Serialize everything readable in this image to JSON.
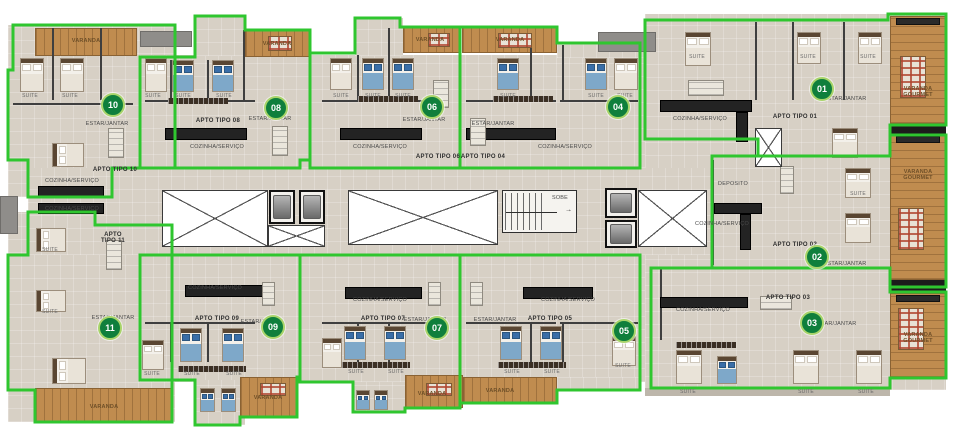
{
  "colors": {
    "outline_green": "#2fc62f",
    "badge_fill": "#0f7f3c",
    "badge_ring": "#a8d46a",
    "floor_beige": "#d7d0c5",
    "wood_tan": "#c08c4f",
    "counter_black": "#232323",
    "background": "#ffffff"
  },
  "apartments": [
    {
      "number": "01",
      "label": "APTO TIPO 01",
      "badge_x": 822,
      "badge_y": 89,
      "label_x": 795,
      "label_y": 117
    },
    {
      "number": "02",
      "label": "APTO TIPO 02",
      "badge_x": 817,
      "badge_y": 257,
      "label_x": 795,
      "label_y": 245
    },
    {
      "number": "03",
      "label": "APTO TIPO 03",
      "badge_x": 812,
      "badge_y": 323,
      "label_x": 788,
      "label_y": 298
    },
    {
      "number": "04",
      "label": "APTO TIPO 04",
      "badge_x": 618,
      "badge_y": 107,
      "label_x": 483,
      "label_y": 157
    },
    {
      "number": "05",
      "label": "APTO TIPO 05",
      "badge_x": 624,
      "badge_y": 331,
      "label_x": 550,
      "label_y": 319
    },
    {
      "number": "06",
      "label": "APTO TIPO 06",
      "badge_x": 432,
      "badge_y": 107,
      "label_x": 438,
      "label_y": 157
    },
    {
      "number": "07",
      "label": "APTO TIPO 07",
      "badge_x": 437,
      "badge_y": 328,
      "label_x": 383,
      "label_y": 319
    },
    {
      "number": "08",
      "label": "APTO TIPO 08",
      "badge_x": 276,
      "badge_y": 108,
      "label_x": 218,
      "label_y": 121
    },
    {
      "number": "09",
      "label": "APTO TIPO 09",
      "badge_x": 273,
      "badge_y": 327,
      "label_x": 217,
      "label_y": 319
    },
    {
      "number": "10",
      "label": "APTO TIPO 10",
      "badge_x": 113,
      "badge_y": 105,
      "label_x": 115,
      "label_y": 170
    },
    {
      "number": "11",
      "label": "APTO TIPO 11",
      "badge_x": 110,
      "badge_y": 328,
      "label_x": 113,
      "label_y": 238,
      "wrap": true
    }
  ],
  "labels": [
    {
      "text": "ESTAR/JANTAR",
      "x": 107,
      "y": 124,
      "cls": "rm"
    },
    {
      "text": "ESTAR/JANTAR",
      "x": 270,
      "y": 119,
      "cls": "rm"
    },
    {
      "text": "ESTAR/JANTAR",
      "x": 424,
      "y": 120,
      "cls": "rm"
    },
    {
      "text": "ESTAR/JANTAR",
      "x": 493,
      "y": 124,
      "cls": "rm"
    },
    {
      "text": "ESTAR/JANTAR",
      "x": 845,
      "y": 99,
      "cls": "rm"
    },
    {
      "text": "ESTAR/JANTAR",
      "x": 845,
      "y": 264,
      "cls": "rm"
    },
    {
      "text": "ESTAR/JANTAR",
      "x": 835,
      "y": 324,
      "cls": "rm"
    },
    {
      "text": "ESTAR/JANTAR",
      "x": 495,
      "y": 320,
      "cls": "rm"
    },
    {
      "text": "ESTAR/JANTAR",
      "x": 425,
      "y": 320,
      "cls": "rm"
    },
    {
      "text": "ESTAR/JANTAR",
      "x": 262,
      "y": 322,
      "cls": "rm"
    },
    {
      "text": "ESTAR/JANTAR",
      "x": 113,
      "y": 318,
      "cls": "rm"
    },
    {
      "text": "COZINHA/SERVIÇO",
      "x": 72,
      "y": 181,
      "cls": "rm"
    },
    {
      "text": "COZINHA/SERVIÇO",
      "x": 72,
      "y": 209,
      "cls": "rm"
    },
    {
      "text": "COZINHA/SERVIÇO",
      "x": 217,
      "y": 147,
      "cls": "rm"
    },
    {
      "text": "COZINHA/SERVIÇO",
      "x": 380,
      "y": 147,
      "cls": "rm"
    },
    {
      "text": "COZINHA/SERVIÇO",
      "x": 565,
      "y": 147,
      "cls": "rm"
    },
    {
      "text": "COZINHA/SERVIÇO",
      "x": 700,
      "y": 119,
      "cls": "rm"
    },
    {
      "text": "COZINHA/SERVIÇO",
      "x": 215,
      "y": 288,
      "cls": "rm"
    },
    {
      "text": "COZINHA/SERVIÇO",
      "x": 380,
      "y": 300,
      "cls": "rm"
    },
    {
      "text": "COZINHA/SERVIÇO",
      "x": 568,
      "y": 300,
      "cls": "rm"
    },
    {
      "text": "COZINHA/SERVIÇO",
      "x": 722,
      "y": 224,
      "cls": "rm"
    },
    {
      "text": "COZINHA/SERVIÇO",
      "x": 703,
      "y": 310,
      "cls": "rm"
    },
    {
      "text": "VARANDA",
      "x": 86,
      "y": 41,
      "cls": "wd"
    },
    {
      "text": "VARANDA",
      "x": 277,
      "y": 44,
      "cls": "wd"
    },
    {
      "text": "VARANDA",
      "x": 430,
      "y": 40,
      "cls": "wd"
    },
    {
      "text": "VARANDA",
      "x": 510,
      "y": 40,
      "cls": "wd"
    },
    {
      "text": "VARANDA",
      "x": 104,
      "y": 407,
      "cls": "wd"
    },
    {
      "text": "VARANDA",
      "x": 268,
      "y": 398,
      "cls": "wd"
    },
    {
      "text": "VARANDA",
      "x": 432,
      "y": 394,
      "cls": "wd"
    },
    {
      "text": "VARANDA",
      "x": 500,
      "y": 391,
      "cls": "wd"
    },
    {
      "text": "VARANDA GOURMET",
      "x": 918,
      "y": 92,
      "cls": "vg"
    },
    {
      "text": "VARANDA GOURMET",
      "x": 918,
      "y": 175,
      "cls": "vg"
    },
    {
      "text": "VARANDA GOURMET",
      "x": 918,
      "y": 338,
      "cls": "vg"
    },
    {
      "text": "DEPOSITO",
      "x": 733,
      "y": 184,
      "cls": "rm"
    },
    {
      "text": "SOBE",
      "x": 560,
      "y": 198,
      "cls": "rm"
    },
    {
      "text": "SUITE",
      "x": 30,
      "y": 96,
      "cls": "su"
    },
    {
      "text": "SUITE",
      "x": 70,
      "y": 96,
      "cls": "su"
    },
    {
      "text": "SUITE",
      "x": 153,
      "y": 96,
      "cls": "su"
    },
    {
      "text": "SUITE",
      "x": 183,
      "y": 96,
      "cls": "su"
    },
    {
      "text": "SUITE",
      "x": 224,
      "y": 96,
      "cls": "su"
    },
    {
      "text": "SUITE",
      "x": 341,
      "y": 96,
      "cls": "su"
    },
    {
      "text": "SUITE",
      "x": 373,
      "y": 96,
      "cls": "su"
    },
    {
      "text": "SUITE",
      "x": 403,
      "y": 96,
      "cls": "su"
    },
    {
      "text": "SUITE",
      "x": 508,
      "y": 96,
      "cls": "su"
    },
    {
      "text": "SUITE",
      "x": 596,
      "y": 96,
      "cls": "su"
    },
    {
      "text": "SUITE",
      "x": 625,
      "y": 96,
      "cls": "su"
    },
    {
      "text": "SUITE",
      "x": 697,
      "y": 57,
      "cls": "su"
    },
    {
      "text": "SUITE",
      "x": 808,
      "y": 57,
      "cls": "su"
    },
    {
      "text": "SUITE",
      "x": 868,
      "y": 57,
      "cls": "su"
    },
    {
      "text": "SUITE",
      "x": 858,
      "y": 194,
      "cls": "su"
    },
    {
      "text": "SUITE",
      "x": 152,
      "y": 374,
      "cls": "su"
    },
    {
      "text": "SUITE",
      "x": 192,
      "y": 374,
      "cls": "su"
    },
    {
      "text": "SUITE",
      "x": 234,
      "y": 374,
      "cls": "su"
    },
    {
      "text": "SUITE",
      "x": 356,
      "y": 372,
      "cls": "su"
    },
    {
      "text": "SUITE",
      "x": 396,
      "y": 372,
      "cls": "su"
    },
    {
      "text": "SUITE",
      "x": 512,
      "y": 372,
      "cls": "su"
    },
    {
      "text": "SUITE",
      "x": 552,
      "y": 372,
      "cls": "su"
    },
    {
      "text": "SUITE",
      "x": 623,
      "y": 366,
      "cls": "su"
    },
    {
      "text": "SUITE",
      "x": 688,
      "y": 392,
      "cls": "su"
    },
    {
      "text": "SUITE",
      "x": 806,
      "y": 392,
      "cls": "su"
    },
    {
      "text": "SUITE",
      "x": 866,
      "y": 392,
      "cls": "su"
    },
    {
      "text": "SUITE",
      "x": 50,
      "y": 250,
      "cls": "su"
    },
    {
      "text": "SUITE",
      "x": 50,
      "y": 312,
      "cls": "su"
    }
  ]
}
